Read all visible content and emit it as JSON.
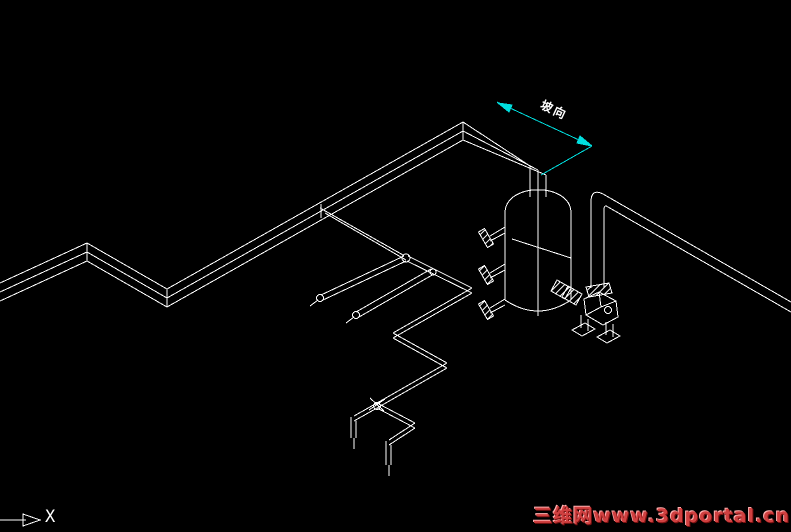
{
  "canvas": {
    "width": 791,
    "height": 532,
    "bg_color": "#000000",
    "line_color": "#ffffff",
    "accent_color": "#00dede",
    "watermark_color": "#d04040"
  },
  "annotations": {
    "dimension_label": "坡向",
    "axis_label": "X",
    "watermark": "三维网www.3dportal.cn"
  },
  "drawing": {
    "title": "isometric-piping-with-scrubber-vessel-and-pump",
    "elements": [
      {
        "name": "main-pipe-line",
        "type": "polyline",
        "pts": [
          [
            0,
            283
          ],
          [
            87,
            243
          ],
          [
            167,
            289
          ],
          [
            463,
            122
          ],
          [
            530,
            166
          ]
        ]
      },
      {
        "name": "main-pipe-line",
        "type": "polyline",
        "pts": [
          [
            0,
            292
          ],
          [
            87,
            252
          ],
          [
            167,
            298
          ],
          [
            463,
            131
          ],
          [
            538,
            170
          ]
        ]
      },
      {
        "name": "main-pipe-line",
        "type": "polyline",
        "pts": [
          [
            0,
            301
          ],
          [
            87,
            261
          ],
          [
            167,
            307
          ],
          [
            463,
            140
          ],
          [
            546,
            175
          ]
        ]
      },
      {
        "name": "pipe-joint-tick",
        "type": "line",
        "p": [
          87,
          243,
          87,
          261
        ]
      },
      {
        "name": "pipe-joint-tick",
        "type": "line",
        "p": [
          167,
          289,
          167,
          307
        ]
      },
      {
        "name": "pipe-joint-tick",
        "type": "line",
        "p": [
          463,
          122,
          463,
          140
        ]
      },
      {
        "name": "pipe-joint-tick",
        "type": "line",
        "p": [
          321,
          204,
          321,
          218
        ]
      },
      {
        "name": "vessel-neck-line",
        "type": "line",
        "p": [
          530,
          166,
          530,
          197
        ]
      },
      {
        "name": "vessel-neck-line",
        "type": "line",
        "p": [
          546,
          175,
          546,
          197
        ]
      },
      {
        "name": "vessel-centerline",
        "type": "line",
        "p": [
          538,
          170,
          538,
          316
        ]
      },
      {
        "name": "vessel-dome",
        "type": "path",
        "d": "M505,213 C505,182 571,182 571,213"
      },
      {
        "name": "vessel-wall",
        "type": "line",
        "p": [
          505,
          213,
          505,
          300
        ]
      },
      {
        "name": "vessel-wall",
        "type": "line",
        "p": [
          571,
          213,
          571,
          300
        ]
      },
      {
        "name": "vessel-bottom",
        "type": "path",
        "d": "M505,300 Q538,322 571,300"
      },
      {
        "name": "vessel-level-line",
        "type": "line",
        "p": [
          512,
          239,
          571,
          258
        ]
      },
      {
        "name": "nozzle-stub",
        "type": "line",
        "p": [
          505,
          227,
          490,
          236
        ]
      },
      {
        "name": "nozzle-stub",
        "type": "line",
        "p": [
          505,
          233,
          490,
          241
        ]
      },
      {
        "name": "nozzle-flange",
        "type": "polygon",
        "fill": "hatch",
        "pts": [
          [
            493.5,
            244
          ],
          [
            487.5,
            247.5
          ],
          [
            478.5,
            232
          ],
          [
            484.5,
            228.5
          ]
        ]
      },
      {
        "name": "nozzle-stub",
        "type": "line",
        "p": [
          505,
          264,
          490,
          273
        ]
      },
      {
        "name": "nozzle-stub",
        "type": "line",
        "p": [
          505,
          270,
          490,
          278
        ]
      },
      {
        "name": "nozzle-flange",
        "type": "polygon",
        "fill": "hatch",
        "pts": [
          [
            493.5,
            281
          ],
          [
            487.5,
            284.5
          ],
          [
            478.5,
            269
          ],
          [
            484.5,
            265.5
          ]
        ]
      },
      {
        "name": "nozzle-stub",
        "type": "line",
        "p": [
          505,
          299,
          490,
          308
        ]
      },
      {
        "name": "nozzle-stub",
        "type": "line",
        "p": [
          505,
          305,
          490,
          313
        ]
      },
      {
        "name": "nozzle-flange",
        "type": "polygon",
        "fill": "hatch",
        "pts": [
          [
            493.5,
            316
          ],
          [
            487.5,
            319.5
          ],
          [
            478.5,
            304
          ],
          [
            484.5,
            300.5
          ]
        ]
      },
      {
        "name": "pump-suction-flange",
        "type": "polygon",
        "fill": "hatch",
        "pts": [
          [
            557,
            280
          ],
          [
            571,
            288
          ],
          [
            565,
            299
          ],
          [
            551,
            291
          ]
        ]
      },
      {
        "name": "pump-suction-flange",
        "type": "polygon",
        "fill": "hatch",
        "pts": [
          [
            568,
            286
          ],
          [
            582,
            294
          ],
          [
            576,
            305
          ],
          [
            562,
            297
          ]
        ]
      },
      {
        "name": "pump-discharge-flange",
        "type": "polygon",
        "fill": "hatch",
        "pts": [
          [
            586,
            287
          ],
          [
            609,
            283
          ],
          [
            612,
            293
          ],
          [
            589,
            297
          ]
        ]
      },
      {
        "name": "pump-casing",
        "type": "polygon",
        "fill": "none",
        "pts": [
          [
            584,
            299
          ],
          [
            599,
            292
          ],
          [
            616,
            301
          ],
          [
            618,
            317
          ],
          [
            603,
            325
          ],
          [
            586,
            315
          ]
        ]
      },
      {
        "name": "pump-casing-detail",
        "type": "line",
        "p": [
          599,
          292,
          601,
          307
        ]
      },
      {
        "name": "pump-casing-detail",
        "type": "line",
        "p": [
          586,
          315,
          601,
          307
        ]
      },
      {
        "name": "pump-casing-detail",
        "type": "line",
        "p": [
          601,
          307,
          616,
          301
        ]
      },
      {
        "name": "pump-casing-detail",
        "type": "circle",
        "c": [
          608,
          310
        ],
        "r": 3.5
      },
      {
        "name": "pump-leg",
        "type": "line",
        "p": [
          581,
          315,
          581,
          328
        ]
      },
      {
        "name": "pump-leg",
        "type": "line",
        "p": [
          588,
          319,
          588,
          331
        ]
      },
      {
        "name": "pump-leg",
        "type": "line",
        "p": [
          606,
          322,
          606,
          335
        ]
      },
      {
        "name": "pump-leg",
        "type": "line",
        "p": [
          613,
          324,
          613,
          337
        ]
      },
      {
        "name": "pump-foot-pad",
        "type": "polygon",
        "fill": "none",
        "pts": [
          [
            572,
            330
          ],
          [
            585,
            323
          ],
          [
            595,
            329
          ],
          [
            582,
            336
          ]
        ]
      },
      {
        "name": "pump-foot-pad",
        "type": "polygon",
        "fill": "none",
        "pts": [
          [
            597,
            337
          ],
          [
            610,
            330
          ],
          [
            620,
            336
          ],
          [
            607,
            343
          ]
        ]
      },
      {
        "name": "riser-pipe-outline",
        "type": "path",
        "d": "M791,302 L603,194 Q591,188 591,202 L591,288"
      },
      {
        "name": "riser-pipe-outline",
        "type": "path",
        "d": "M791,312 L608,207 Q604,204 604,210 L604,288"
      },
      {
        "name": "branch-pipe-line",
        "type": "line",
        "p": [
          320,
          208,
          403,
          255
        ]
      },
      {
        "name": "branch-pipe-line",
        "type": "line",
        "p": [
          325,
          213,
          406,
          260
        ]
      },
      {
        "name": "pipe-fitting",
        "type": "circle",
        "c": [
          406,
          258
        ],
        "r": 4
      },
      {
        "name": "branch-pipe-line",
        "type": "line",
        "p": [
          408,
          256,
          472,
          288
        ]
      },
      {
        "name": "branch-pipe-line",
        "type": "line",
        "p": [
          407,
          261,
          472,
          293
        ]
      },
      {
        "name": "pipe-fitting",
        "type": "circle",
        "c": [
          433,
          272
        ],
        "r": 3
      },
      {
        "name": "branch-pipe-line",
        "type": "line",
        "p": [
          472,
          288,
          393,
          333
        ]
      },
      {
        "name": "branch-pipe-line",
        "type": "line",
        "p": [
          472,
          293,
          393,
          338
        ]
      },
      {
        "name": "branch-pipe-line",
        "type": "line",
        "p": [
          393,
          333,
          447,
          363
        ]
      },
      {
        "name": "branch-pipe-line",
        "type": "line",
        "p": [
          393,
          338,
          447,
          368
        ]
      },
      {
        "name": "branch-pipe-line",
        "type": "line",
        "p": [
          447,
          363,
          377,
          403
        ]
      },
      {
        "name": "branch-pipe-line",
        "type": "line",
        "p": [
          447,
          368,
          377,
          408
        ]
      },
      {
        "name": "pipe-fitting",
        "type": "circle",
        "c": [
          377,
          406
        ],
        "r": 3.5
      },
      {
        "name": "valve-cross-mark",
        "type": "line",
        "p": [
          369,
          410,
          385,
          399
        ]
      },
      {
        "name": "valve-cross-mark",
        "type": "line",
        "p": [
          370,
          398,
          384,
          411
        ]
      },
      {
        "name": "branch-pipe-line",
        "type": "line",
        "p": [
          377,
          403,
          354,
          416
        ]
      },
      {
        "name": "branch-pipe-line",
        "type": "line",
        "p": [
          377,
          408,
          354,
          421
        ]
      },
      {
        "name": "pipe-drop-line",
        "type": "line",
        "p": [
          351,
          417,
          351,
          438
        ]
      },
      {
        "name": "pipe-drop-line",
        "type": "line",
        "p": [
          356,
          421,
          356,
          438
        ]
      },
      {
        "name": "pipe-centerline-tail",
        "type": "line",
        "p": [
          354,
          438,
          354,
          449
        ]
      },
      {
        "name": "branch-pipe-line",
        "type": "line",
        "p": [
          377,
          403,
          415,
          423
        ]
      },
      {
        "name": "branch-pipe-line",
        "type": "line",
        "p": [
          377,
          408,
          415,
          428
        ]
      },
      {
        "name": "branch-pipe-line",
        "type": "line",
        "p": [
          415,
          423,
          389,
          440
        ]
      },
      {
        "name": "branch-pipe-line",
        "type": "line",
        "p": [
          415,
          428,
          389,
          445
        ]
      },
      {
        "name": "pipe-drop-line",
        "type": "line",
        "p": [
          386,
          441,
          386,
          465
        ]
      },
      {
        "name": "pipe-drop-line",
        "type": "line",
        "p": [
          391,
          445,
          391,
          465
        ]
      },
      {
        "name": "pipe-centerline-tail",
        "type": "line",
        "p": [
          389,
          465,
          389,
          476
        ]
      },
      {
        "name": "branch-pipe-line",
        "type": "line",
        "p": [
          404,
          256,
          321,
          295
        ]
      },
      {
        "name": "branch-pipe-line",
        "type": "line",
        "p": [
          406,
          261,
          323,
          300
        ]
      },
      {
        "name": "pipe-end-cap",
        "type": "circle",
        "c": [
          320,
          298
        ],
        "r": 3.5
      },
      {
        "name": "pipe-centerline-tail",
        "type": "line",
        "p": [
          318,
          300,
          310,
          306
        ]
      },
      {
        "name": "branch-pipe-line",
        "type": "line",
        "p": [
          431,
          269,
          356,
          312
        ]
      },
      {
        "name": "branch-pipe-line",
        "type": "line",
        "p": [
          434,
          274,
          359,
          317
        ]
      },
      {
        "name": "pipe-end-cap",
        "type": "circle",
        "c": [
          356,
          315
        ],
        "r": 3.5
      },
      {
        "name": "pipe-centerline-tail",
        "type": "line",
        "p": [
          354,
          317,
          346,
          323
        ]
      },
      {
        "name": "dimension-line",
        "type": "line",
        "color": "accent",
        "p": [
          497,
          102,
          592,
          146
        ]
      },
      {
        "name": "dimension-arrow",
        "type": "polygon",
        "color": "accent",
        "fill": "accent",
        "pts": [
          [
            498,
            103
          ],
          [
            509,
            112
          ],
          [
            512,
            105
          ]
        ]
      },
      {
        "name": "dimension-arrow",
        "type": "polygon",
        "color": "accent",
        "fill": "accent",
        "pts": [
          [
            592,
            146
          ],
          [
            577,
            143
          ],
          [
            580,
            136
          ]
        ]
      },
      {
        "name": "dimension-extension-line",
        "type": "line",
        "color": "accent",
        "p": [
          592,
          146,
          541,
          175
        ]
      },
      {
        "name": "axis-arrow-line",
        "type": "line",
        "p": [
          0,
          520,
          26,
          520
        ]
      },
      {
        "name": "axis-arrowhead",
        "type": "polygon",
        "fill": "none",
        "pts": [
          [
            40,
            520
          ],
          [
            23,
            514
          ],
          [
            23,
            526
          ]
        ]
      }
    ]
  }
}
